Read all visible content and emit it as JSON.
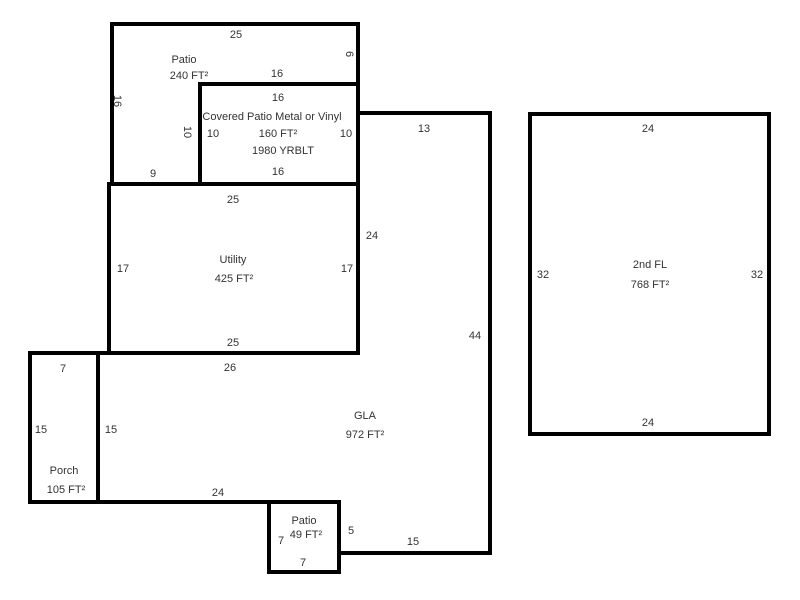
{
  "canvas": {
    "width": 800,
    "height": 600,
    "background": "#ffffff",
    "wall_color": "#000000",
    "room_fill": "#ffffff",
    "text_color": "#333333",
    "wall_thickness": 4,
    "font_size": 11
  },
  "sketch": {
    "type": "floor-plan",
    "scale_px_per_ft": 10,
    "rooms": [
      {
        "id": "patio-240",
        "name": "Patio",
        "area": "240 FT²",
        "points": [
          [
            112,
            24
          ],
          [
            358,
            24
          ],
          [
            358,
            84
          ],
          [
            200,
            84
          ],
          [
            200,
            184
          ],
          [
            112,
            184
          ]
        ]
      },
      {
        "id": "covered-patio",
        "name": "Covered Patio Metal or Vinyl",
        "area": "160 FT²",
        "year_built": "1980 YRBLT",
        "points": [
          [
            200,
            84
          ],
          [
            358,
            84
          ],
          [
            358,
            184
          ],
          [
            200,
            184
          ]
        ]
      },
      {
        "id": "utility",
        "name": "Utility",
        "area": "425 FT²",
        "points": [
          [
            109,
            184
          ],
          [
            358,
            184
          ],
          [
            358,
            353
          ],
          [
            109,
            353
          ]
        ]
      },
      {
        "id": "gla",
        "name": "GLA",
        "area": "972 FT²",
        "points": [
          [
            358,
            113
          ],
          [
            490,
            113
          ],
          [
            490,
            553
          ],
          [
            339,
            553
          ],
          [
            339,
            502
          ],
          [
            98,
            502
          ],
          [
            98,
            353
          ],
          [
            358,
            353
          ]
        ]
      },
      {
        "id": "porch",
        "name": "Porch",
        "area": "105 FT²",
        "points": [
          [
            30,
            353
          ],
          [
            98,
            353
          ],
          [
            98,
            502
          ],
          [
            30,
            502
          ]
        ]
      },
      {
        "id": "patio-49",
        "name": "Patio",
        "area": "49 FT²",
        "points": [
          [
            269,
            502
          ],
          [
            339,
            502
          ],
          [
            339,
            572
          ],
          [
            269,
            572
          ]
        ]
      },
      {
        "id": "second-floor",
        "name": "2nd FL",
        "area": "768 FT²",
        "points": [
          [
            530,
            114
          ],
          [
            769,
            114
          ],
          [
            769,
            434
          ],
          [
            530,
            434
          ]
        ]
      }
    ],
    "labels": [
      {
        "id": "dim-patio240-top",
        "text": "25",
        "x": 236,
        "y": 34,
        "rotate": 0
      },
      {
        "id": "room-patio240-name",
        "text": "Patio",
        "x": 184,
        "y": 59,
        "rotate": 0
      },
      {
        "id": "room-patio240-area",
        "text": "240 FT²",
        "x": 189,
        "y": 75,
        "rotate": 0
      },
      {
        "id": "dim-patio240-left",
        "text": "16",
        "x": 118,
        "y": 101,
        "rotate": 90
      },
      {
        "id": "dim-patio240-right",
        "text": "6",
        "x": 350,
        "y": 54,
        "rotate": 90
      },
      {
        "id": "dim-covered-patio-top-outer",
        "text": "16",
        "x": 277,
        "y": 73,
        "rotate": 0
      },
      {
        "id": "dim-patio240-bottom",
        "text": "9",
        "x": 153,
        "y": 173,
        "rotate": 0
      },
      {
        "id": "dim-covered-patio-top",
        "text": "16",
        "x": 278,
        "y": 97,
        "rotate": 0
      },
      {
        "id": "room-covered-patio-name",
        "text": "Covered Patio Metal or Vinyl",
        "x": 272,
        "y": 116,
        "rotate": 0
      },
      {
        "id": "dim-covered-patio-left-outer",
        "text": "10",
        "x": 188,
        "y": 132,
        "rotate": 90
      },
      {
        "id": "dim-covered-patio-left",
        "text": "10",
        "x": 213,
        "y": 133,
        "rotate": 0
      },
      {
        "id": "room-covered-patio-area",
        "text": "160 FT²",
        "x": 278,
        "y": 133,
        "rotate": 0
      },
      {
        "id": "dim-covered-patio-right",
        "text": "10",
        "x": 346,
        "y": 133,
        "rotate": 0
      },
      {
        "id": "room-covered-patio-yrblt",
        "text": "1980 YRBLT",
        "x": 283,
        "y": 150,
        "rotate": 0
      },
      {
        "id": "dim-covered-patio-bottom",
        "text": "16",
        "x": 278,
        "y": 171,
        "rotate": 0
      },
      {
        "id": "dim-utility-top",
        "text": "25",
        "x": 233,
        "y": 199,
        "rotate": 0
      },
      {
        "id": "dim-utility-left",
        "text": "17",
        "x": 123,
        "y": 268,
        "rotate": 0
      },
      {
        "id": "room-utility-name",
        "text": "Utility",
        "x": 233,
        "y": 259,
        "rotate": 0
      },
      {
        "id": "room-utility-area",
        "text": "425 FT²",
        "x": 234,
        "y": 278,
        "rotate": 0
      },
      {
        "id": "dim-utility-right",
        "text": "17",
        "x": 347,
        "y": 268,
        "rotate": 0
      },
      {
        "id": "dim-utility-bottom",
        "text": "25",
        "x": 233,
        "y": 342,
        "rotate": 0
      },
      {
        "id": "dim-gla-top",
        "text": "13",
        "x": 424,
        "y": 128,
        "rotate": 0
      },
      {
        "id": "dim-gla-left-upper",
        "text": "24",
        "x": 372,
        "y": 235,
        "rotate": 0
      },
      {
        "id": "dim-gla-right",
        "text": "44",
        "x": 475,
        "y": 335,
        "rotate": 0
      },
      {
        "id": "dim-gla-top-left",
        "text": "26",
        "x": 230,
        "y": 367,
        "rotate": 0
      },
      {
        "id": "dim-gla-left-lower",
        "text": "15",
        "x": 111,
        "y": 429,
        "rotate": 0
      },
      {
        "id": "room-gla-name",
        "text": "GLA",
        "x": 365,
        "y": 415,
        "rotate": 0
      },
      {
        "id": "room-gla-area",
        "text": "972 FT²",
        "x": 365,
        "y": 434,
        "rotate": 0
      },
      {
        "id": "dim-gla-bottom-left",
        "text": "24",
        "x": 218,
        "y": 492,
        "rotate": 0
      },
      {
        "id": "dim-gla-step",
        "text": "5",
        "x": 351,
        "y": 530,
        "rotate": 0
      },
      {
        "id": "dim-gla-bottom-right",
        "text": "15",
        "x": 413,
        "y": 541,
        "rotate": 0
      },
      {
        "id": "dim-porch-top",
        "text": "7",
        "x": 63,
        "y": 368,
        "rotate": 0
      },
      {
        "id": "dim-porch-left",
        "text": "15",
        "x": 41,
        "y": 429,
        "rotate": 0
      },
      {
        "id": "room-porch-name",
        "text": "Porch",
        "x": 64,
        "y": 470,
        "rotate": 0
      },
      {
        "id": "room-porch-area",
        "text": "105 FT²",
        "x": 66,
        "y": 489,
        "rotate": 0
      },
      {
        "id": "room-patio49-name",
        "text": "Patio",
        "x": 304,
        "y": 520,
        "rotate": 0
      },
      {
        "id": "room-patio49-area",
        "text": "49 FT²",
        "x": 306,
        "y": 534,
        "rotate": 0
      },
      {
        "id": "dim-patio49-left",
        "text": "7",
        "x": 281,
        "y": 540,
        "rotate": 0
      },
      {
        "id": "dim-patio49-bottom",
        "text": "7",
        "x": 303,
        "y": 562,
        "rotate": 0
      },
      {
        "id": "dim-2ndfl-top",
        "text": "24",
        "x": 648,
        "y": 128,
        "rotate": 0
      },
      {
        "id": "dim-2ndfl-left",
        "text": "32",
        "x": 543,
        "y": 274,
        "rotate": 0
      },
      {
        "id": "room-2ndfl-name",
        "text": "2nd FL",
        "x": 650,
        "y": 264,
        "rotate": 0
      },
      {
        "id": "room-2ndfl-area",
        "text": "768 FT²",
        "x": 650,
        "y": 284,
        "rotate": 0
      },
      {
        "id": "dim-2ndfl-right",
        "text": "32",
        "x": 757,
        "y": 274,
        "rotate": 0
      },
      {
        "id": "dim-2ndfl-bottom",
        "text": "24",
        "x": 648,
        "y": 422,
        "rotate": 0
      }
    ]
  }
}
